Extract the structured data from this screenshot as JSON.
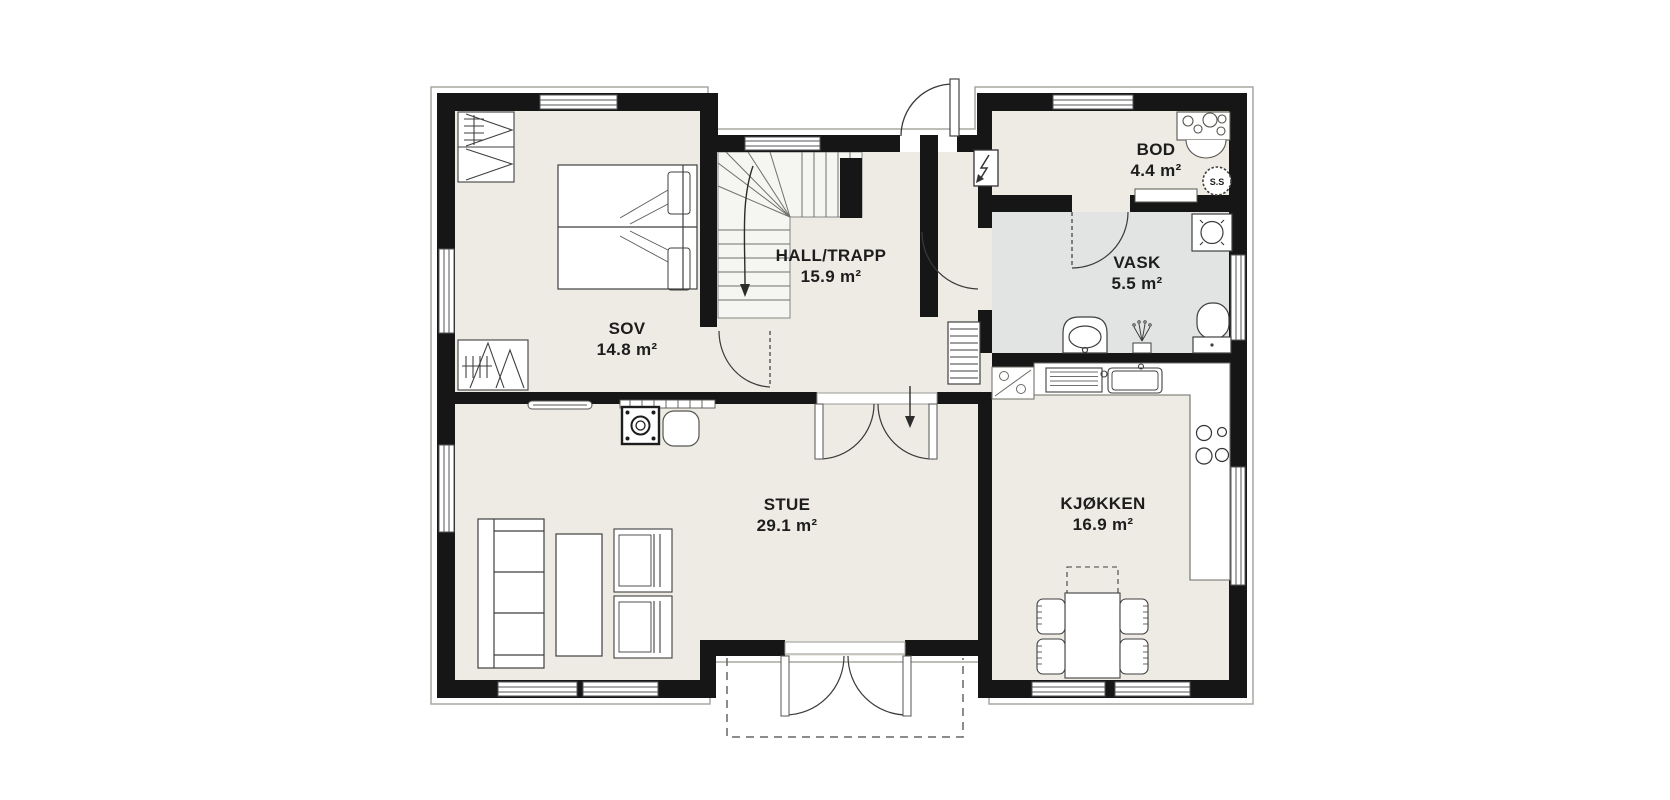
{
  "title": "Floor plan – first floor",
  "colors": {
    "wall": "#161616",
    "floor": "#edebe3",
    "wet_room_floor": "#e2e4e3",
    "stair_floor": "#f5f5f2",
    "outline": "#a8a8a2",
    "furniture_line": "#3f3f3f",
    "background": "#ffffff"
  },
  "rooms": [
    {
      "id": "sov",
      "name": "SOV",
      "area": "14.8 m²"
    },
    {
      "id": "hall",
      "name": "HALL/TRAPP",
      "area": "15.9 m²"
    },
    {
      "id": "bod",
      "name": "BOD",
      "area": "4.4 m²"
    },
    {
      "id": "vask",
      "name": "VASK",
      "area": "5.5 m²"
    },
    {
      "id": "stue",
      "name": "STUE",
      "area": "29.1 m²"
    },
    {
      "id": "kjokken",
      "name": "KJØKKEN",
      "area": "16.9 m²"
    }
  ],
  "labels": {
    "water_heater": "S.S"
  }
}
